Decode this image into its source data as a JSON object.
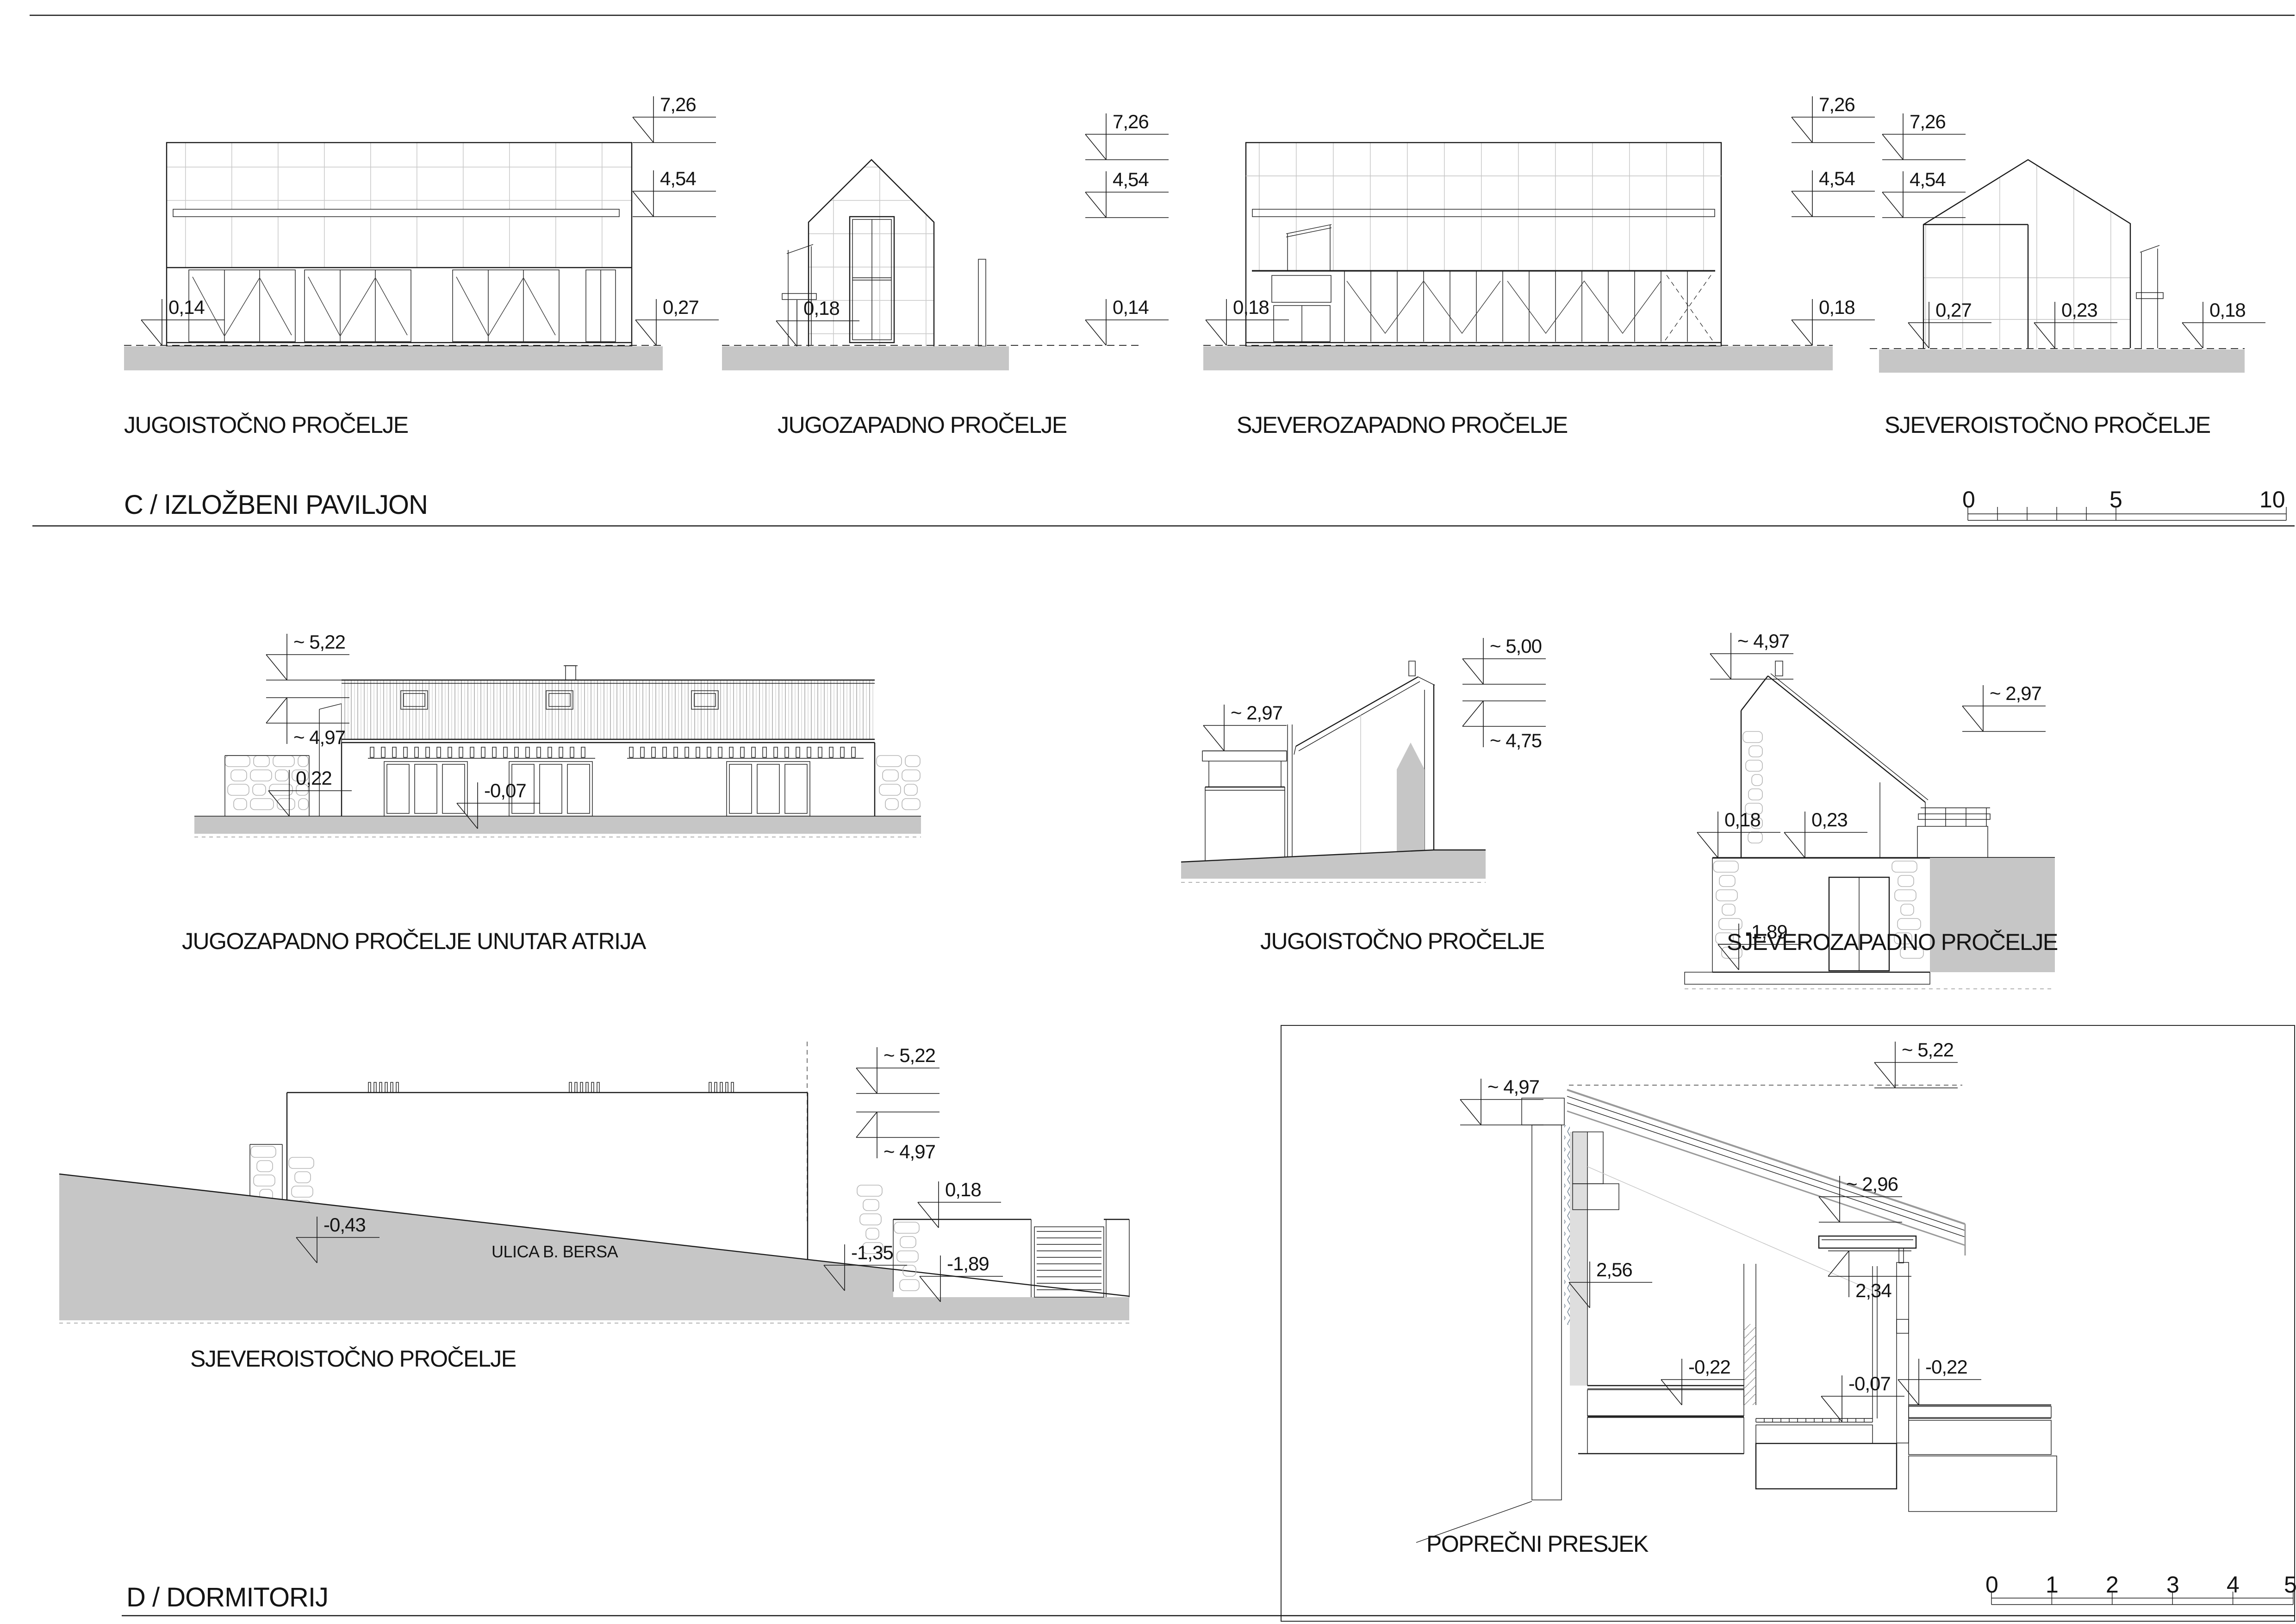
{
  "sheet": {
    "background": "#ffffff",
    "line_color": "#1a1a1a",
    "ground_fill": "#c6c6c6",
    "section_c": {
      "title": "C / IZLOŽBENI PAVILJON",
      "scale_bar": {
        "ticks": [
          "0",
          "5",
          "10"
        ]
      },
      "elevations": [
        {
          "label": "JUGOISTOČNO PROČELJE",
          "dims": {
            "top": "7,26",
            "mid": "4,54",
            "base_left": "0,14",
            "base_right": "0,27"
          }
        },
        {
          "label": "JUGOZAPADNO PROČELJE",
          "dims": {
            "top": "7,26",
            "mid": "4,54",
            "base_left": "0,18",
            "base_right": "0,14"
          }
        },
        {
          "label": "SJEVEROZAPADNO PROČELJE",
          "dims": {
            "top": "7,26",
            "mid": "4,54",
            "base_left": "0,18",
            "base_right": "0,18"
          }
        },
        {
          "label": "SJEVEROISTOČNO PROČELJE",
          "dims": {
            "top": "7,26",
            "mid": "4,54",
            "base_left": "0,27",
            "base_center": "0,23",
            "base_right": "0,18"
          }
        }
      ]
    },
    "section_d": {
      "title": "D / DORMITORIJ",
      "scale_bar": {
        "ticks": [
          "0",
          "1",
          "2",
          "3",
          "4",
          "5"
        ]
      },
      "views": [
        {
          "label": "JUGOZAPADNO PROČELJE UNUTAR ATRIJA",
          "dims": {
            "ridge": "~ 5,22",
            "eaves": "~ 4,97",
            "terrace": "0,22",
            "floor": "-0,07"
          }
        },
        {
          "label": "JUGOISTOČNO PROČELJE",
          "dims": {
            "canopy": "~ 2,97",
            "ridge": "~ 5,00",
            "eaves": "~ 4,75"
          }
        },
        {
          "label": "SJEVEROZAPADNO PROČELJE",
          "dims": {
            "ridge": "~ 4,97",
            "annex": "~ 2,97",
            "base_left": "0,18",
            "base_center": "0,23",
            "street": "-1,89"
          }
        },
        {
          "label": "SJEVEROISTOČNO PROČELJE",
          "street_name": "ULICA B. BERSA",
          "dims": {
            "ridge": "~ 5,22",
            "eaves": "~ 4,97",
            "street_left": "-0,43",
            "street_mid": "-1,35",
            "wall_top": "0,18",
            "gate": "-1,89"
          }
        },
        {
          "label": "POPREČNI PRESJEK",
          "dims": {
            "left_top": "~ 4,97",
            "right_top": "~ 5,22",
            "canopy_top": "~ 2,96",
            "canopy_under": "2,34",
            "interior": "2,56",
            "floor_left": "-0,22",
            "floor_mid": "-0,07",
            "floor_right": "-0,22"
          }
        }
      ]
    }
  }
}
